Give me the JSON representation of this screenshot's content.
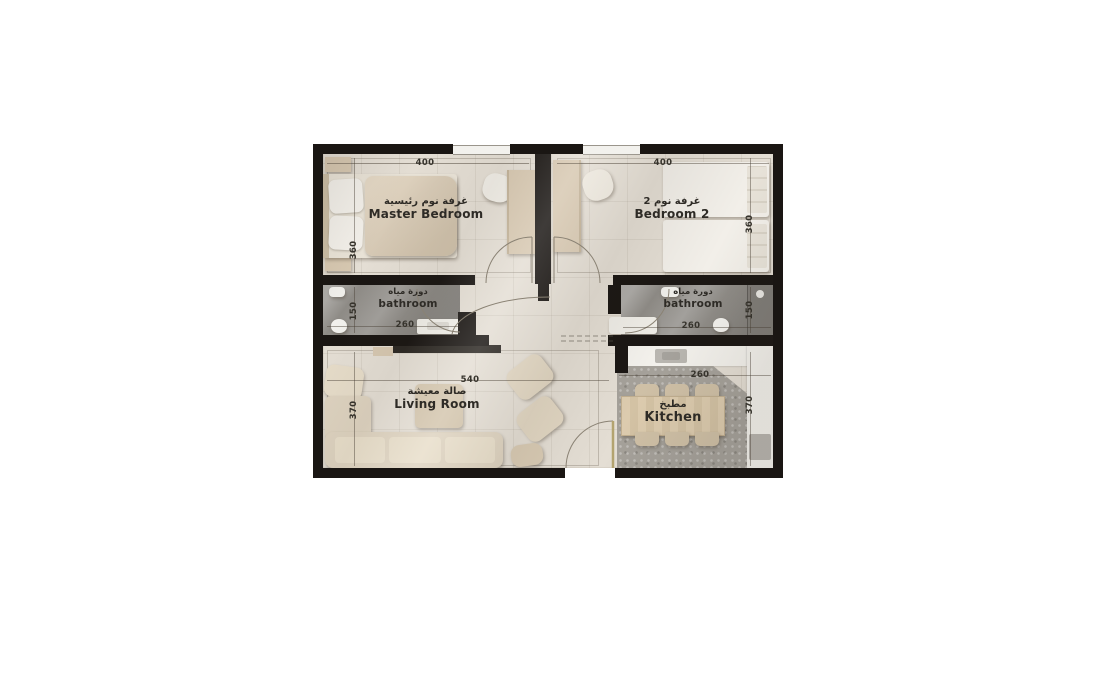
{
  "plan": {
    "type": "apartment-floor-plan",
    "rooms": {
      "master_bedroom": {
        "label_ar": "غرفة نوم رئيسية",
        "label_en": "Master Bedroom",
        "dim_width": "400",
        "dim_height": "360"
      },
      "bedroom_2": {
        "label_ar": "غرفة نوم 2",
        "label_en": "Bedroom 2",
        "dim_width": "400",
        "dim_height": "360"
      },
      "bathroom_left": {
        "label_ar": "دورة مياه",
        "label_en": "bathroom",
        "dim_width": "260",
        "dim_height": "150"
      },
      "bathroom_right": {
        "label_ar": "دورة مياه",
        "label_en": "bathroom",
        "dim_width": "260",
        "dim_height": "150"
      },
      "living_room": {
        "label_ar": "صالة معيشة",
        "label_en": "Living Room",
        "dim_width": "540",
        "dim_height": "370"
      },
      "kitchen": {
        "label_ar": "مطبخ",
        "label_en": "Kitchen",
        "dim_width": "260",
        "dim_height": "370"
      }
    },
    "colors": {
      "wall": "#1a1613",
      "floor": "#e4ded4",
      "bathroom_floor": "#8e8b86",
      "kitchen_floor": "#a5a19a",
      "furniture_tan": "#d7c8b1",
      "furniture_white": "#f1eee8",
      "page_background": "#ffffff"
    }
  }
}
